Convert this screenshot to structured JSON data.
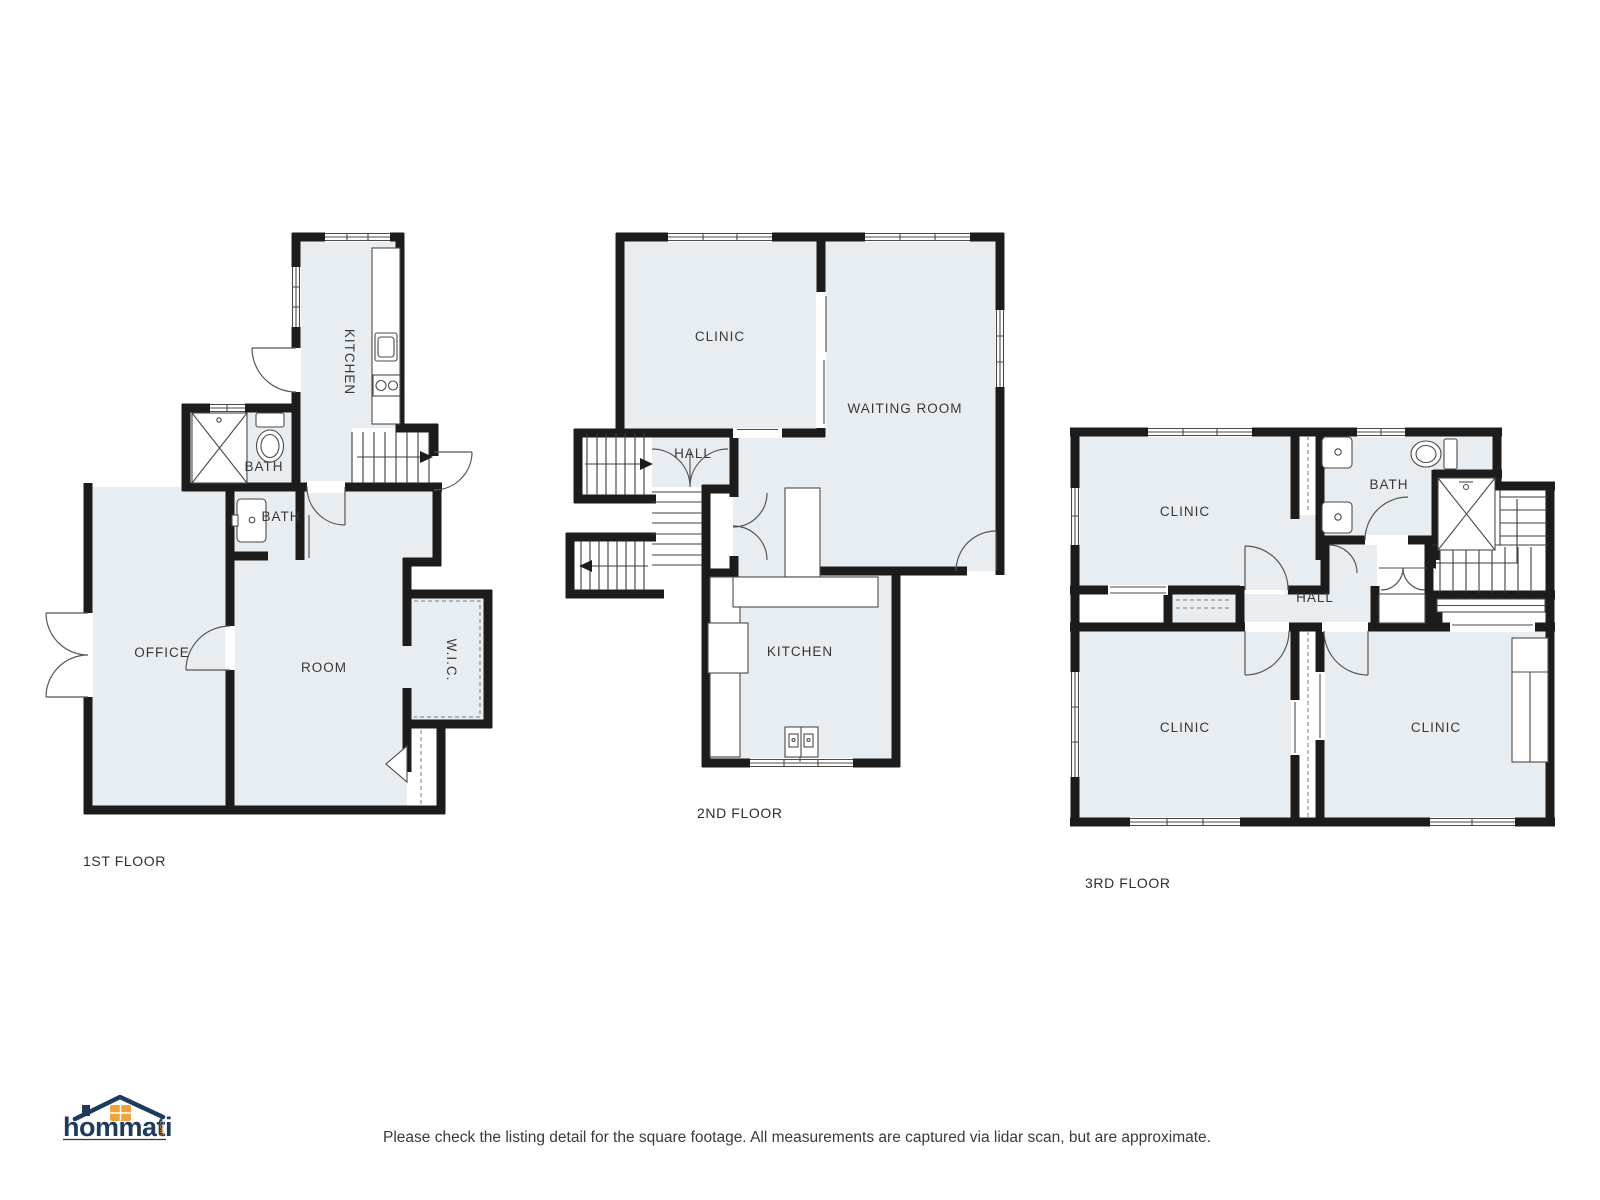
{
  "colors": {
    "wall": "#1c1c1c",
    "room_fill": "#e8edf1",
    "thin_line": "#4a4a4a",
    "label_text": "#383838",
    "logo_navy": "#1e3a5c",
    "logo_orange": "#eea33b"
  },
  "floors": {
    "floor1": {
      "label": "1ST FLOOR",
      "rooms": {
        "kitchen": "KITCHEN",
        "bath_upper": "BATH",
        "bath_lower": "BATH",
        "office": "OFFICE",
        "room": "ROOM",
        "wic": "W.I.C."
      }
    },
    "floor2": {
      "label": "2ND FLOOR",
      "rooms": {
        "clinic": "CLINIC",
        "waiting_room": "WAITING ROOM",
        "hall": "HALL",
        "kitchen": "KITCHEN"
      }
    },
    "floor3": {
      "label": "3RD FLOOR",
      "rooms": {
        "clinic_top": "CLINIC",
        "bath": "BATH",
        "hall": "HALL",
        "clinic_bottom_left": "CLINIC",
        "clinic_bottom_right": "CLINIC"
      }
    }
  },
  "branding": {
    "logo_text": "hommati",
    "logo_suffix": ".com"
  },
  "footer": {
    "disclaimer": "Please check the listing detail for the square footage. All measurements are captured via lidar scan, but are approximate."
  }
}
